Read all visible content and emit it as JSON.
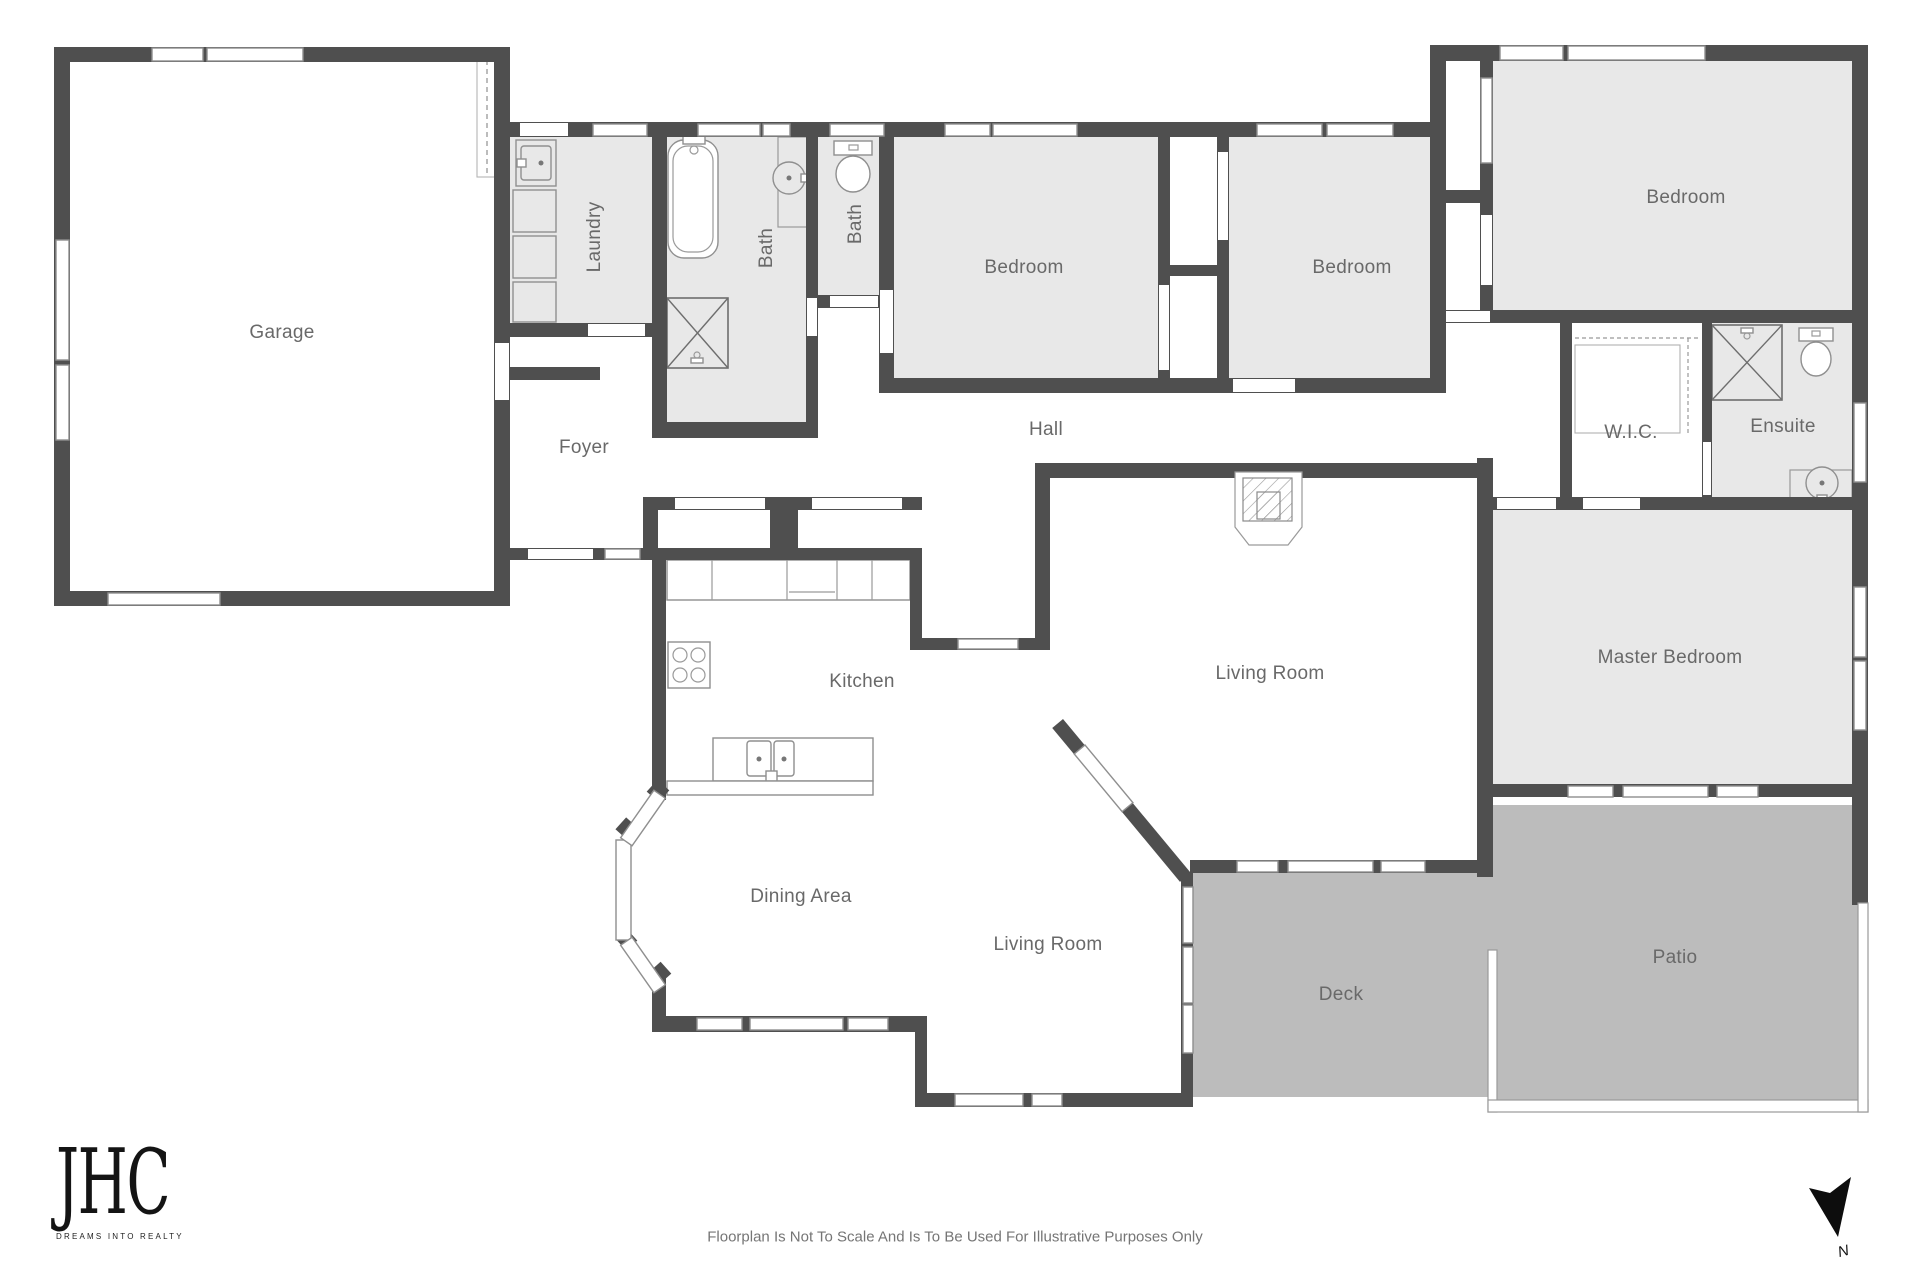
{
  "plan": {
    "type": "residential-floorplan"
  },
  "colors": {
    "wall": "#4f4f4f",
    "room_fill": "#e8e8e8",
    "outdoor_fill": "#bcbcbc",
    "fixture_line": "#8f8f8f",
    "label_text": "#696969"
  },
  "rooms": [
    {
      "label": "Garage"
    },
    {
      "label": "Laundry"
    },
    {
      "label": "Bath"
    },
    {
      "label": "Bath"
    },
    {
      "label": "Bedroom"
    },
    {
      "label": "Bedroom"
    },
    {
      "label": "Bedroom"
    },
    {
      "label": "W.I.C."
    },
    {
      "label": "Ensuite"
    },
    {
      "label": "Foyer"
    },
    {
      "label": "Hall"
    },
    {
      "label": "Kitchen"
    },
    {
      "label": "Living Room"
    },
    {
      "label": "Master Bedroom"
    },
    {
      "label": "Dining Area"
    },
    {
      "label": "Living Room"
    },
    {
      "label": "Deck"
    },
    {
      "label": "Patio"
    }
  ],
  "fixtures": [
    "bathtub",
    "shower",
    "toilet",
    "round-basin",
    "washer",
    "laundry-cabinets",
    "stove",
    "kitchen-counter",
    "island-sink",
    "fireplace",
    "closet-shelving"
  ],
  "branding": {
    "logo_text": "JHC",
    "tagline": "DREAMS INTO REALTY"
  },
  "footer": {
    "disclaimer": "Floorplan Is Not To Scale And Is To Be Used For Illustrative Purposes Only"
  },
  "compass": {
    "north_label": "N"
  }
}
